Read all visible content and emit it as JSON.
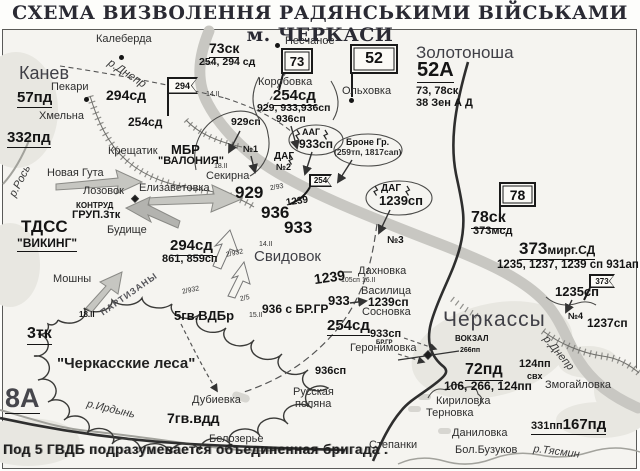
{
  "title": "СХЕМА ВИЗВОЛЕННЯ РАДЯНСЬКИМИ ВІЙСЬКАМИ м. ЧЕРКАСИ",
  "note": "Под 5 ГВДБ подразумевается  объединенная бригада .",
  "flags": {
    "f294": "294",
    "f73": "73",
    "f52": "52",
    "f254": "254",
    "f78": "78",
    "f373": "373"
  },
  "places": {
    "kaleberda": "Калеберда",
    "kanev": "Канев",
    "pekari": "Пекари",
    "khmelna": "Хмельна",
    "kreshchatik": "Крещатик",
    "novaya_guta": "Новая Гута",
    "lozovok": "Лозовок",
    "elizavetovka": "Елизаветовка",
    "sekirna": "Секирна",
    "budishche": "Будище",
    "moshny": "Мошны",
    "peschanoe": "Песчаное",
    "korobovka": "Коробовка",
    "olkhovka": "Ольховка",
    "zolotonosha": "Золотоноша",
    "svidovok": "Свидовок",
    "dakhnovka": "Дахновка",
    "vasilitsa": "Василица",
    "sosnovka": "Сосновка",
    "geronimovka": "Геронимовка",
    "cherkassy": "Черкассы",
    "vokzal": "ВОКЗАЛ",
    "zmogailovka": "Змогайловка",
    "rus_polyana_1": "Русская",
    "rus_polyana_2": "поляна",
    "dubievka": "Дубиевка",
    "belozerye": "Белозерье",
    "kirilovka": "Кириловка",
    "ternovka": "Терновка",
    "danilovka": "Даниловка",
    "bol_buzukov": "Бол.Бузуков",
    "stepanki": "Степанки",
    "forest": "\"Черкасские леса\""
  },
  "rivers": {
    "dnepr": "р.Днепр",
    "ros": "р.Рось",
    "irdyn": "р.Ирдынь",
    "tyasmin": "р.Тясмин"
  },
  "units": {
    "u57pd": "57пд",
    "u332pd": "332пд",
    "u294sd": "294сд",
    "u294sd_sub": "861, 859сп",
    "u254sd": "254сд",
    "u254sd_sub": "929, 933,936сп",
    "u929sp": "929сп",
    "u936sp": "936сп",
    "u933sp": "933сп",
    "mbr": "МБР",
    "valonia": "\"ВАЛОНИЯ\"",
    "tdss": "ТДСС",
    "viking": "\"ВИКИНГ\"",
    "kontrud1": "КОНТРУД",
    "kontrud2": "ГРУП.3тк",
    "u3tk": "3тк",
    "u8a": "8А",
    "u73sk": "73ск",
    "u73sk_sub": "254, 294 сд",
    "u52a": "52А",
    "u52a_sub1": "73, 78ск",
    "u52a_sub2": "38 Зен А Д",
    "u78sk": "78ск",
    "u78sk_sub": "373мсд",
    "aag": "ААГ",
    "dag": "ДАГ",
    "bronegr1": "Броне Гр.",
    "bronegr2": "(259тп, 1817сап)",
    "u1239sp": "1239сп",
    "n929": "929",
    "n936": "936",
    "n933": "933",
    "n1239": "1239",
    "u5gv": "5гв.ВДБр",
    "u936brgr": "936 с БР.ГР",
    "brgr": "БР.ГР",
    "u7gv": "7гв.вдд",
    "u72pd": "72пд",
    "u72pd_sub": "106, 266, 124пп",
    "p266": "266пп",
    "p124": "124пп",
    "svx": "свх",
    "u373_num": "373",
    "u373_suffix": "мирг.СД",
    "u373_sub": "1235, 1237, 1239 сп 931ап",
    "u1235sp": "1235сп",
    "u1237sp": "1237сп",
    "u331pp": "331пп",
    "u167pd": "167пд"
  },
  "marks": {
    "n1": "№1",
    "n2": "№2",
    "n3": "№3",
    "n4": "№4",
    "d14": "14.II",
    "d15": "15.II",
    "d18": "18.II",
    "b2_932": "2/932",
    "b2_93": "2/93",
    "b2_5": "2/5",
    "d105": "105сп 16.II",
    "partizany": "ПАРТИЗАНЫ"
  }
}
